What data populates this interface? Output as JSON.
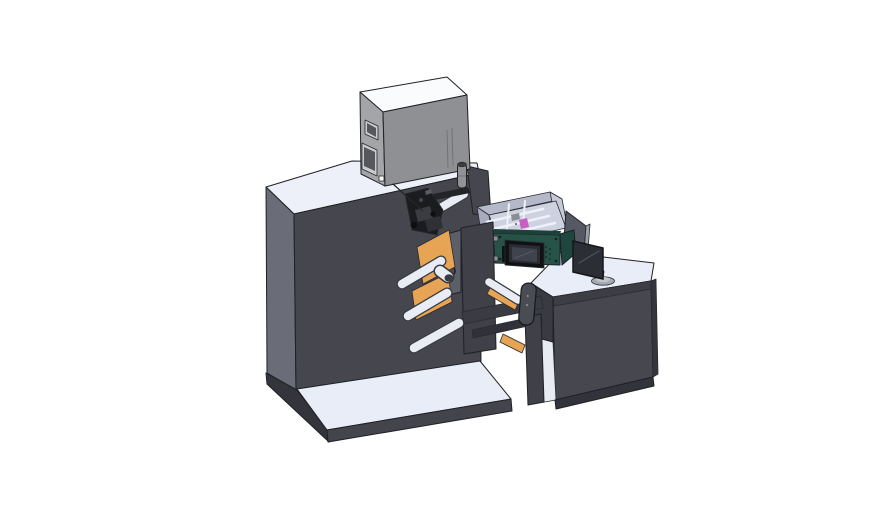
{
  "scene": {
    "subject": "3D CAD render of a label printing machine line with operator desk",
    "background": "#ffffff",
    "parts": [
      "main-cabinet",
      "base-platform",
      "electronics-box",
      "exhaust-cylinder",
      "print-head-mechanism",
      "unwind-tower",
      "guide-rollers",
      "label-web",
      "parts-hopper",
      "control-panel",
      "operator-desk",
      "desk-shelf",
      "monitor",
      "divider-panel",
      "support-beams",
      "handle-widget"
    ]
  },
  "colors": {
    "outline": "#1f2125",
    "machine_front": "#45464e",
    "machine_side": "#6a6c78",
    "machine_top": "#edf0f8",
    "platform_top": "#e9edf7",
    "platform_front": "#43444c",
    "platform_side": "#34353c",
    "box_left": "#a3a5a8",
    "box_right": "#8e9093",
    "box_top": "#fafbfc",
    "box_window_frame": "#c9cbce",
    "box_window_glass": "#55575c",
    "box_square": "#f4f5f6",
    "cylinder": "#909296",
    "cylinder_cap": "#3a3c40",
    "tower_front": "#3f4048",
    "tower_back": "#5d5f68",
    "tower_hole": "#4a4c54",
    "roller_body": "#e9ecf4",
    "roller_outline": "#3a3b40",
    "web_orange": "#e7a455",
    "mech_black": "#1b1c1f",
    "mech_gray": "#3a3c42",
    "mech_mid": "#2e3036",
    "mech_light": "#5a5c63",
    "mech_arm": "#232428",
    "hopper_wall": "#b5b8c9",
    "hopper_wall_outer": "#a8abbd",
    "hopper_wall_light": "#c6c9d8",
    "hopper_floor": "#ced1e0",
    "hopper_slat": "#eef1f8",
    "pink_item": "#c95fc2",
    "gray_item": "#8a8c96",
    "green_front": "#265247",
    "green_side": "#1e463d",
    "green_rim": "#1d4038",
    "green_dot": "#102620",
    "screen_bezel": "#101114",
    "screen_mid": "#2a2c31",
    "screen_face": "#3f434d",
    "clip_gray": "#8b8d95",
    "divider_face": "#565963",
    "divider_edge": "#9ca0aa",
    "desk_top": "#e9edf7",
    "desk_front": "#46474f",
    "desk_strip": "#3d3e45",
    "desk_side": "#393a42",
    "desk_right": "#35363d",
    "desk_base": "#33343b",
    "shelf_interior": "#e8ebf4",
    "leg_dark": "#3f4048",
    "monitor_screen": "#2c2e35",
    "monitor_stand": "#a6a9b0",
    "monitor_stand_top": "#c2c5cb",
    "monitor_neck": "#8d9097",
    "beam_dark": "#3a3b43",
    "beam_darker": "#30313a",
    "handle_gray": "#4a4c54",
    "dot_dark": "#26272b",
    "screw_dark": "#0f231d",
    "glass_hilite": "#555a66"
  }
}
